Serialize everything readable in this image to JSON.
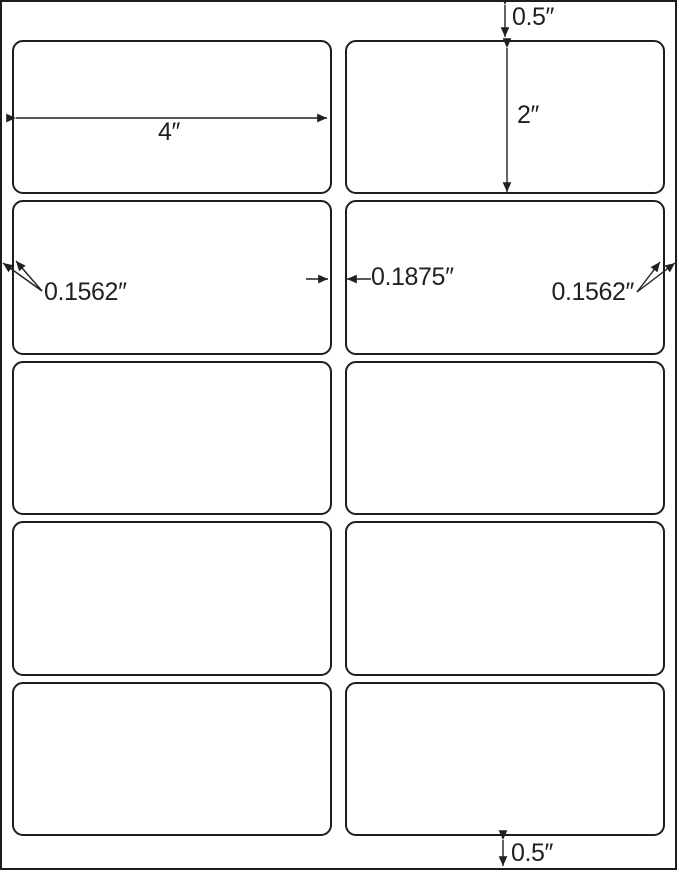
{
  "page": {
    "background": "#ffffff",
    "ink_color": "#231f20"
  },
  "sheet": {
    "rows": 5,
    "columns": 2,
    "label_count": 10
  },
  "dimensions": {
    "top_margin": "0.5″",
    "bottom_margin": "0.5″",
    "label_width": "4″",
    "label_height": "2″",
    "left_margin": "0.1562″",
    "right_margin": "0.1562″",
    "column_gap": "0.1875″"
  }
}
